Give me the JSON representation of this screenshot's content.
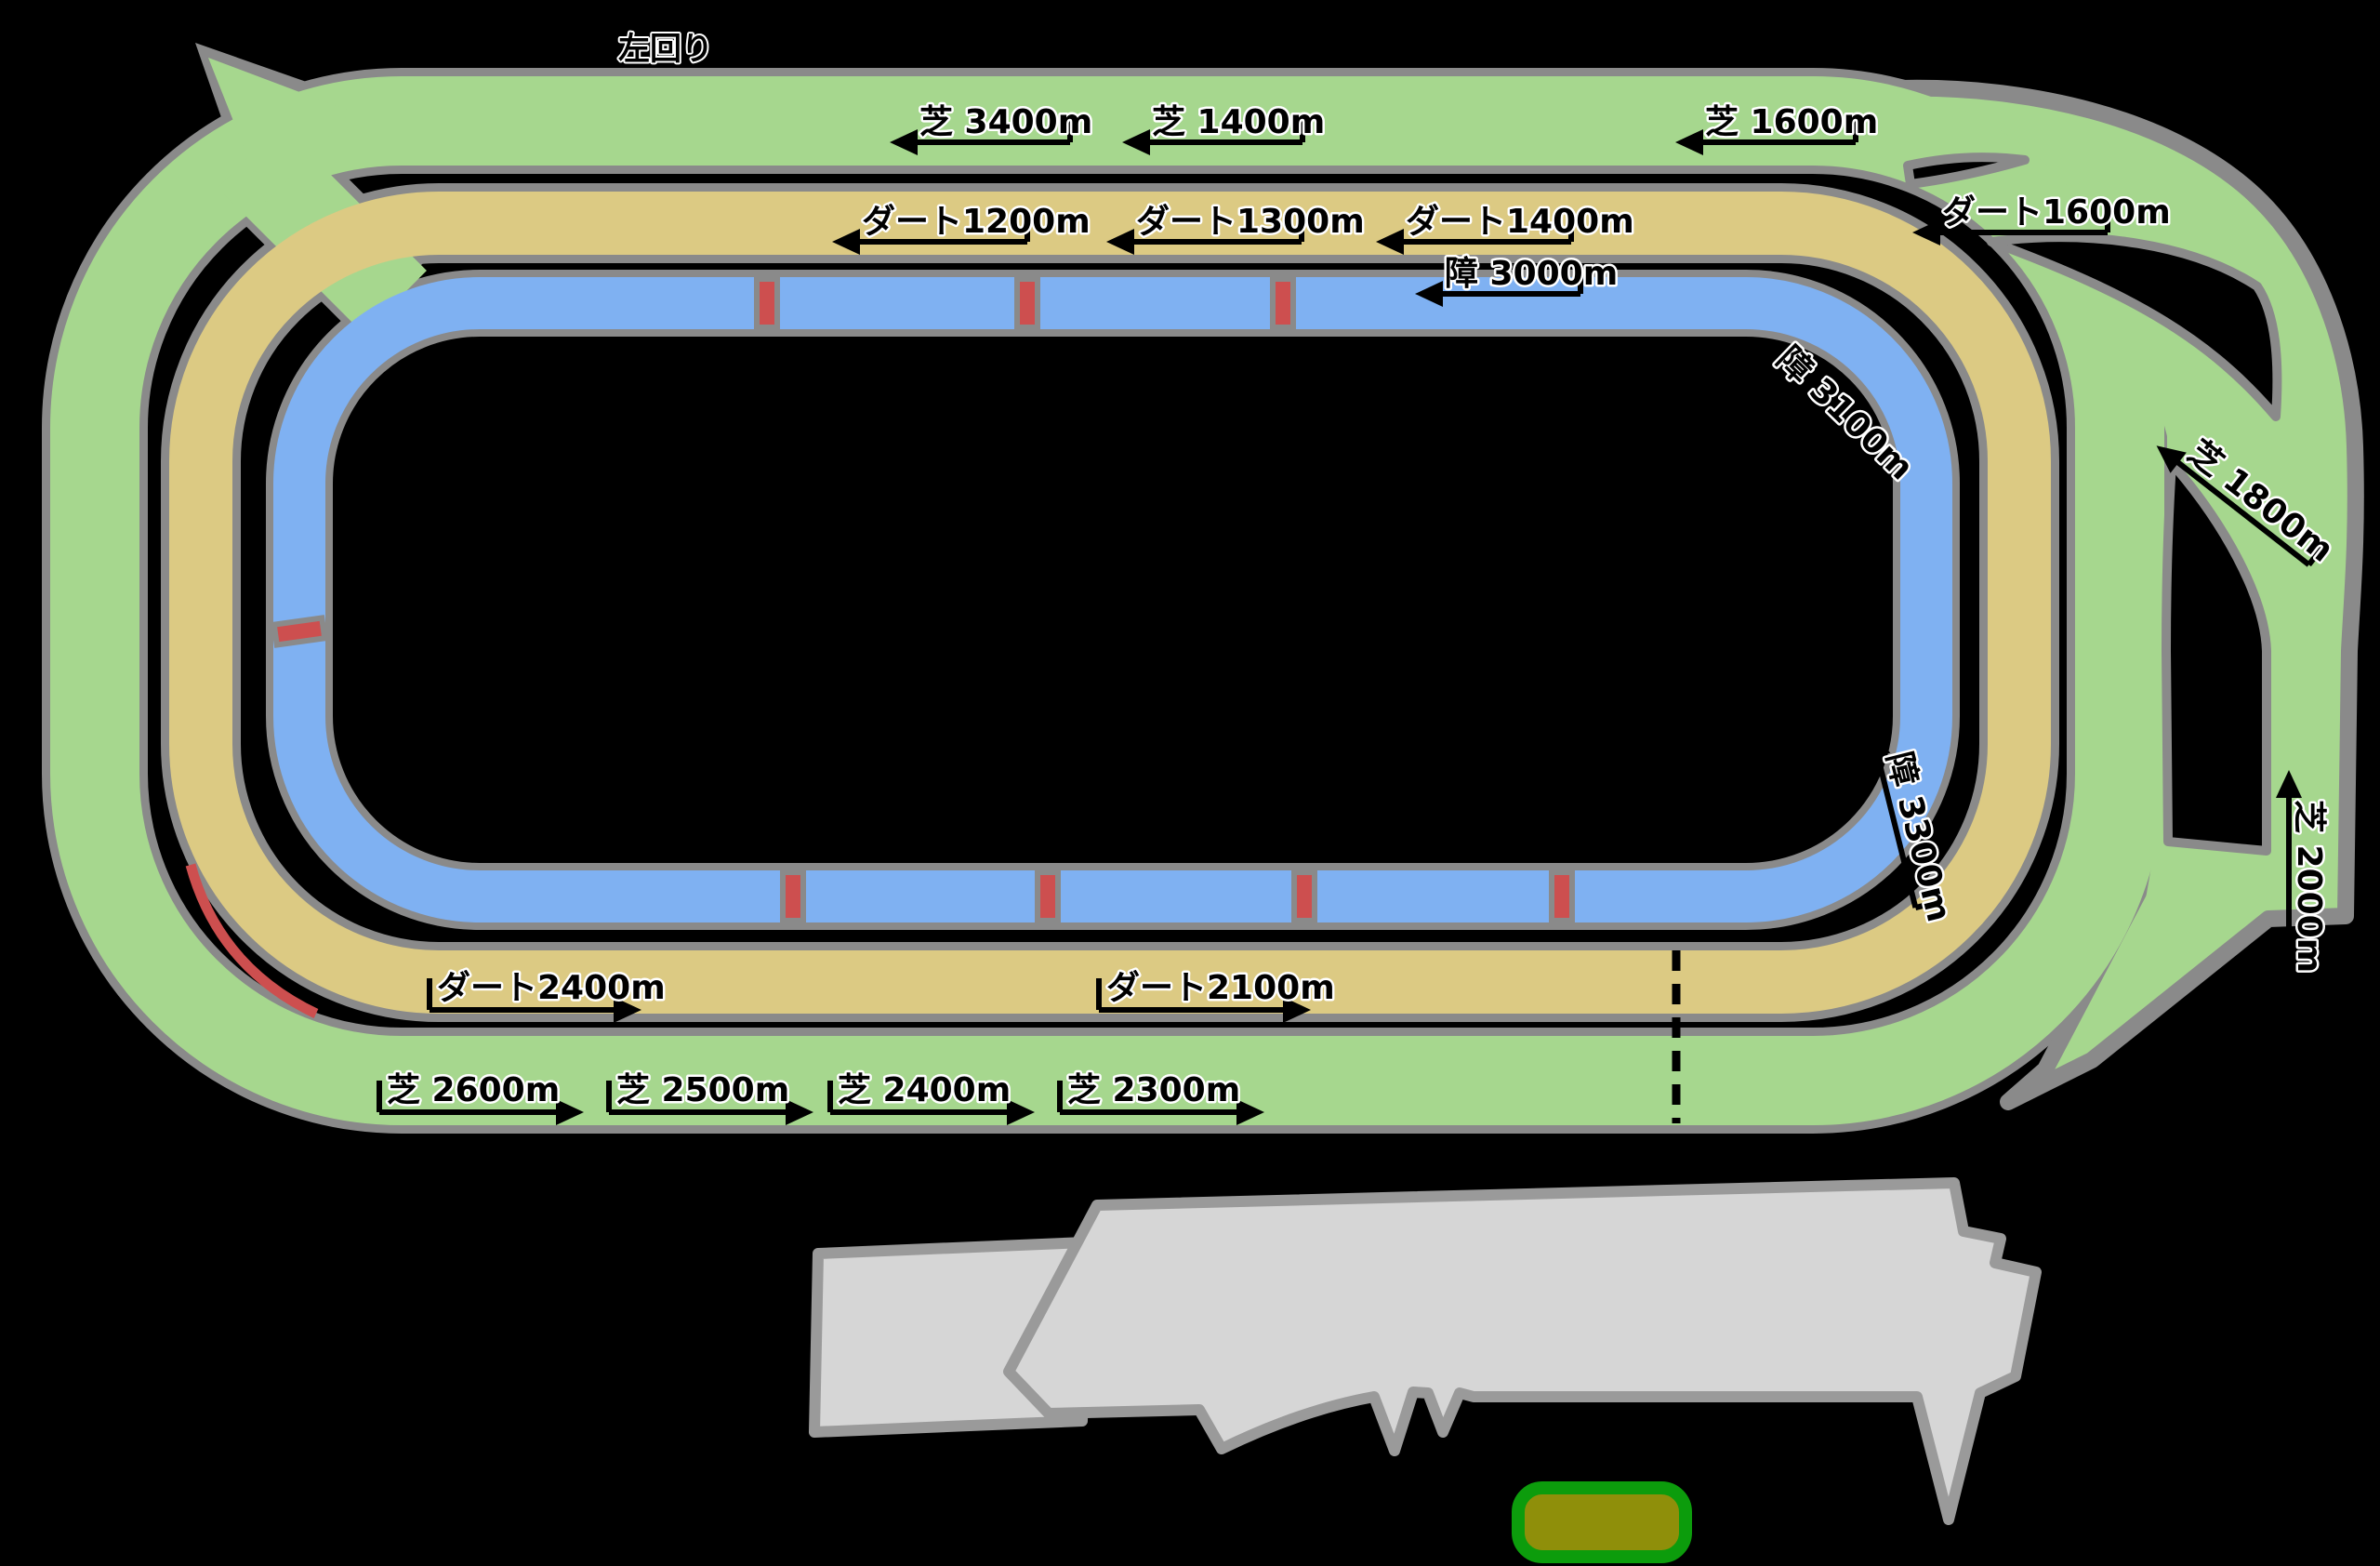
{
  "map_title": "racecourse-track-diagram",
  "direction": {
    "label": "左回り"
  },
  "colors": {
    "background": "#000000",
    "turf": "#a6d78e",
    "dirt": "#dcca83",
    "jump": "#7fb1f2",
    "track_border": "#8a8a8a",
    "hurdle_marker": "#cd4f4f",
    "grandstand": "#d6d6d6",
    "grandstand_border": "#9a9a9a",
    "paddock_fill": "#8f8f0a",
    "paddock_border": "#0c9c0c",
    "label_text": "#000000"
  },
  "labels": {
    "shiba3400": "芝 3400m",
    "shiba1400": "芝 1400m",
    "shiba1600": "芝 1600m",
    "dirt1200": "ダート1200m",
    "dirt1300": "ダート1300m",
    "dirt1400": "ダート1400m",
    "dirt1600": "ダート1600m",
    "jump3000": "障 3000m",
    "jump3100": "障 3100m",
    "jump3300": "障 3300m",
    "shiba1800": "芝 1800m",
    "shiba2000": "芝 2000m",
    "dirt2400": "ダート2400m",
    "dirt2100": "ダート2100m",
    "shiba2600": "芝 2600m",
    "shiba2500": "芝 2500m",
    "shiba2400": "芝 2400m",
    "shiba2300": "芝 2300m"
  },
  "courses": [
    {
      "name": "turf-course",
      "color": "#a6d78e"
    },
    {
      "name": "dirt-course",
      "color": "#dcca83"
    },
    {
      "name": "jump-course",
      "color": "#7fb1f2"
    }
  ],
  "markers": {
    "hurdle_count": 8,
    "finish_line": "dotted"
  }
}
